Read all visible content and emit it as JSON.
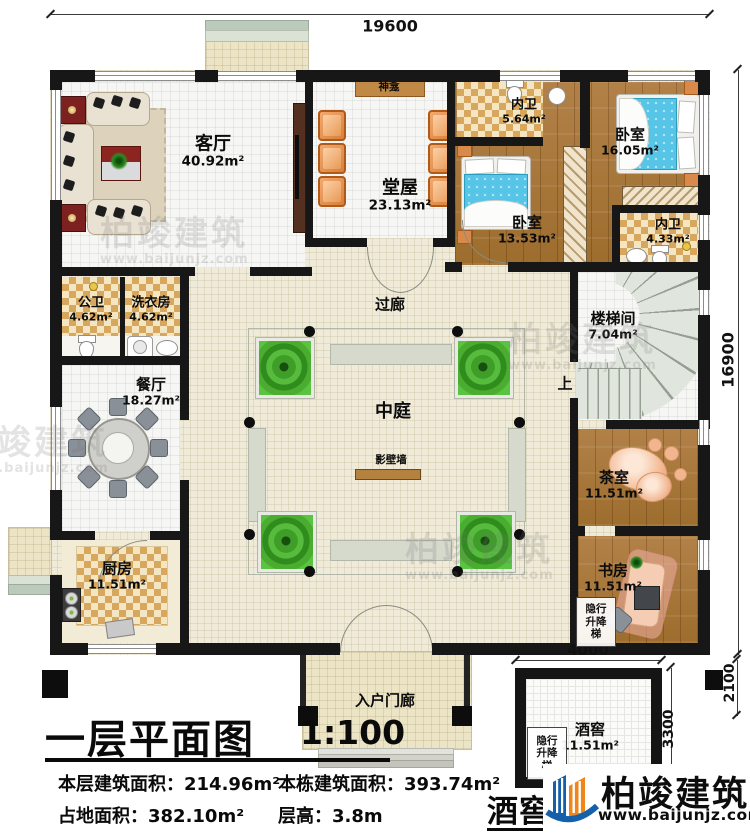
{
  "dimensions": {
    "top": "19600",
    "right": "16900",
    "cellar_top": "4000",
    "cellar_right": "3300",
    "cellar_offset": "2100"
  },
  "rooms": {
    "living": {
      "name": "客厅",
      "area": "40.92m²"
    },
    "hall": {
      "name": "堂屋",
      "area": "23.13m²"
    },
    "shrine": {
      "name": "神龛"
    },
    "bath_top": {
      "name": "内卫",
      "area": "5.64m²"
    },
    "bed_right": {
      "name": "卧室",
      "area": "16.05m²"
    },
    "bed_mid": {
      "name": "卧室",
      "area": "13.53m²"
    },
    "bath_right": {
      "name": "内卫",
      "area": "4.33m²"
    },
    "public_bath": {
      "name": "公卫",
      "area": "4.62m²"
    },
    "laundry": {
      "name": "洗衣房",
      "area": "4.62m²"
    },
    "dining": {
      "name": "餐厅",
      "area": "18.27m²"
    },
    "corridor": {
      "name": "过廊"
    },
    "stairs": {
      "name": "楼梯间",
      "area": "7.04m²"
    },
    "up": {
      "name": "上"
    },
    "courtyard": {
      "name": "中庭"
    },
    "screen_wall": {
      "name": "影壁墙"
    },
    "tea": {
      "name": "茶室",
      "area": "11.51m²"
    },
    "kitchen": {
      "name": "厨房",
      "area": "11.51m²"
    },
    "study": {
      "name": "书房",
      "area": "11.51m²"
    },
    "elevator_study": {
      "name": "隐行升降梯"
    },
    "entry_porch": {
      "name": "入户门廊"
    },
    "cellar": {
      "name": "酒窖",
      "area": "11.51m²"
    },
    "elevator_cellar": {
      "name": "隐行升降梯"
    }
  },
  "title_block": {
    "title": "一层平面图",
    "scale": "1:100",
    "floor_area": "本层建筑面积：214.96m²",
    "building_area": "本栋建筑面积：393.74m²",
    "land_area": "占地面积：382.10m²",
    "floor_height": "层高：3.8m",
    "cellar_title": "酒窖平面图"
  },
  "brand": {
    "name": "柏竣建筑",
    "website": "www.baijunjz.com"
  },
  "watermark": {
    "name": "柏竣建筑",
    "website": "www.baijunjz.com"
  },
  "colors": {
    "wall": "#171717",
    "wood_floor": "#a9783c",
    "checker_tile": "#d8a75e",
    "bed_blue": "#56c5e7",
    "planter_green": "#3e9e28",
    "screen_wall_brown": "#b5813f",
    "brand_blue": "#1460aa",
    "brand_orange": "#f08519"
  }
}
